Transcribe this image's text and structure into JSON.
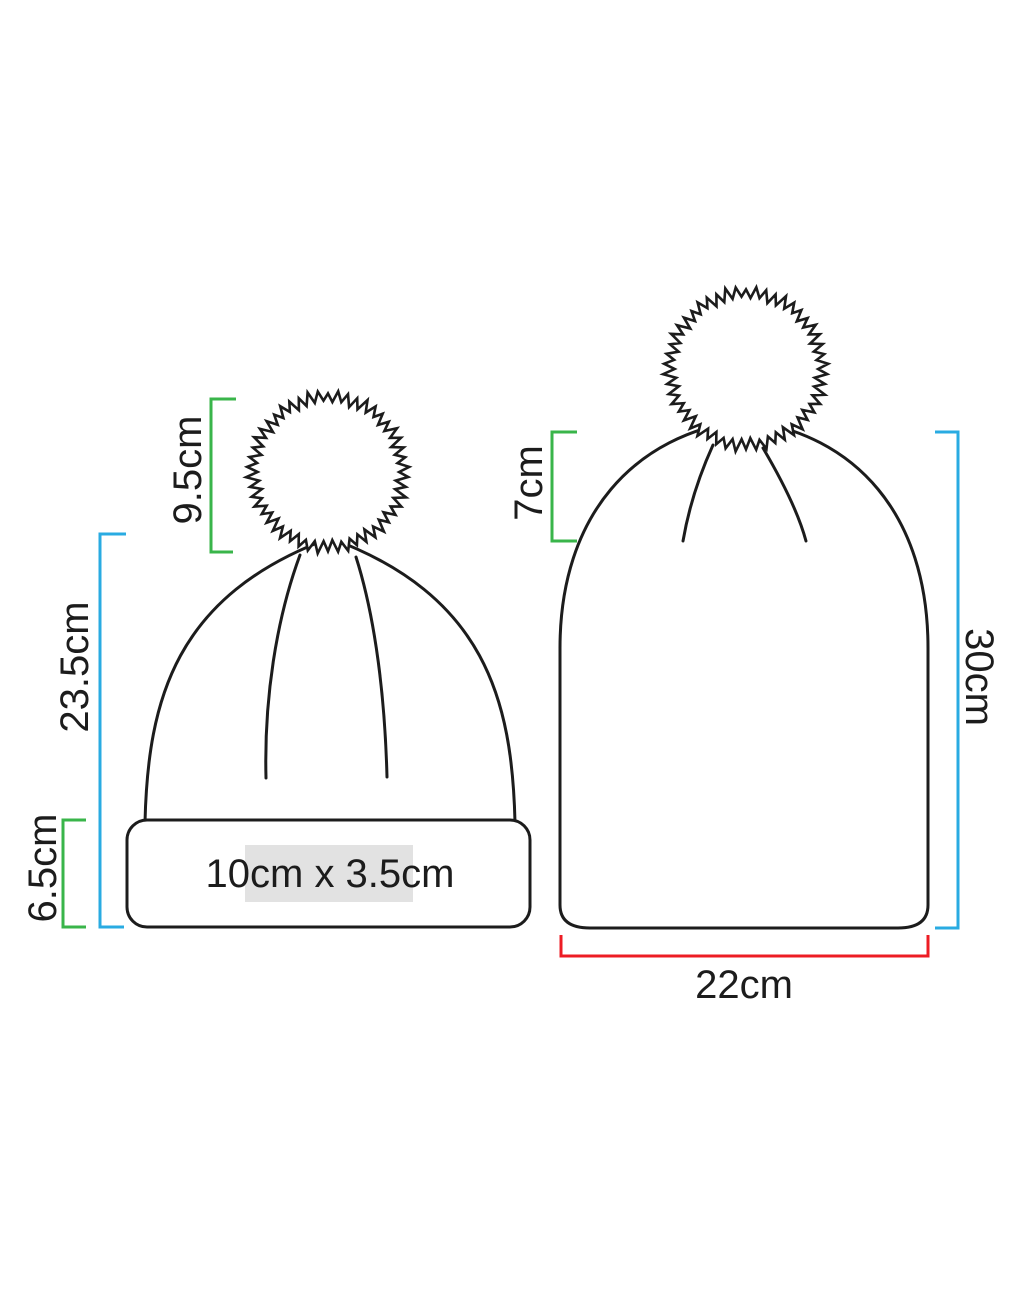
{
  "diagram": {
    "type": "beanie-size-specification",
    "left_beanie": {
      "pom_height_label": "9.5cm",
      "body_height_label": "23.5cm",
      "cuff_height_label": "6.5cm",
      "print_area_label": "10cm x 3.5cm"
    },
    "right_beanie": {
      "crown_depth_label": "7cm",
      "height_label": "30cm",
      "width_label": "22cm"
    },
    "colors": {
      "green_dimension": "#39b54a",
      "blue_dimension": "#29abe2",
      "red_dimension": "#ed1c24",
      "outline": "#1c1c1c",
      "print_area_highlight": "#e2e2e2"
    }
  }
}
